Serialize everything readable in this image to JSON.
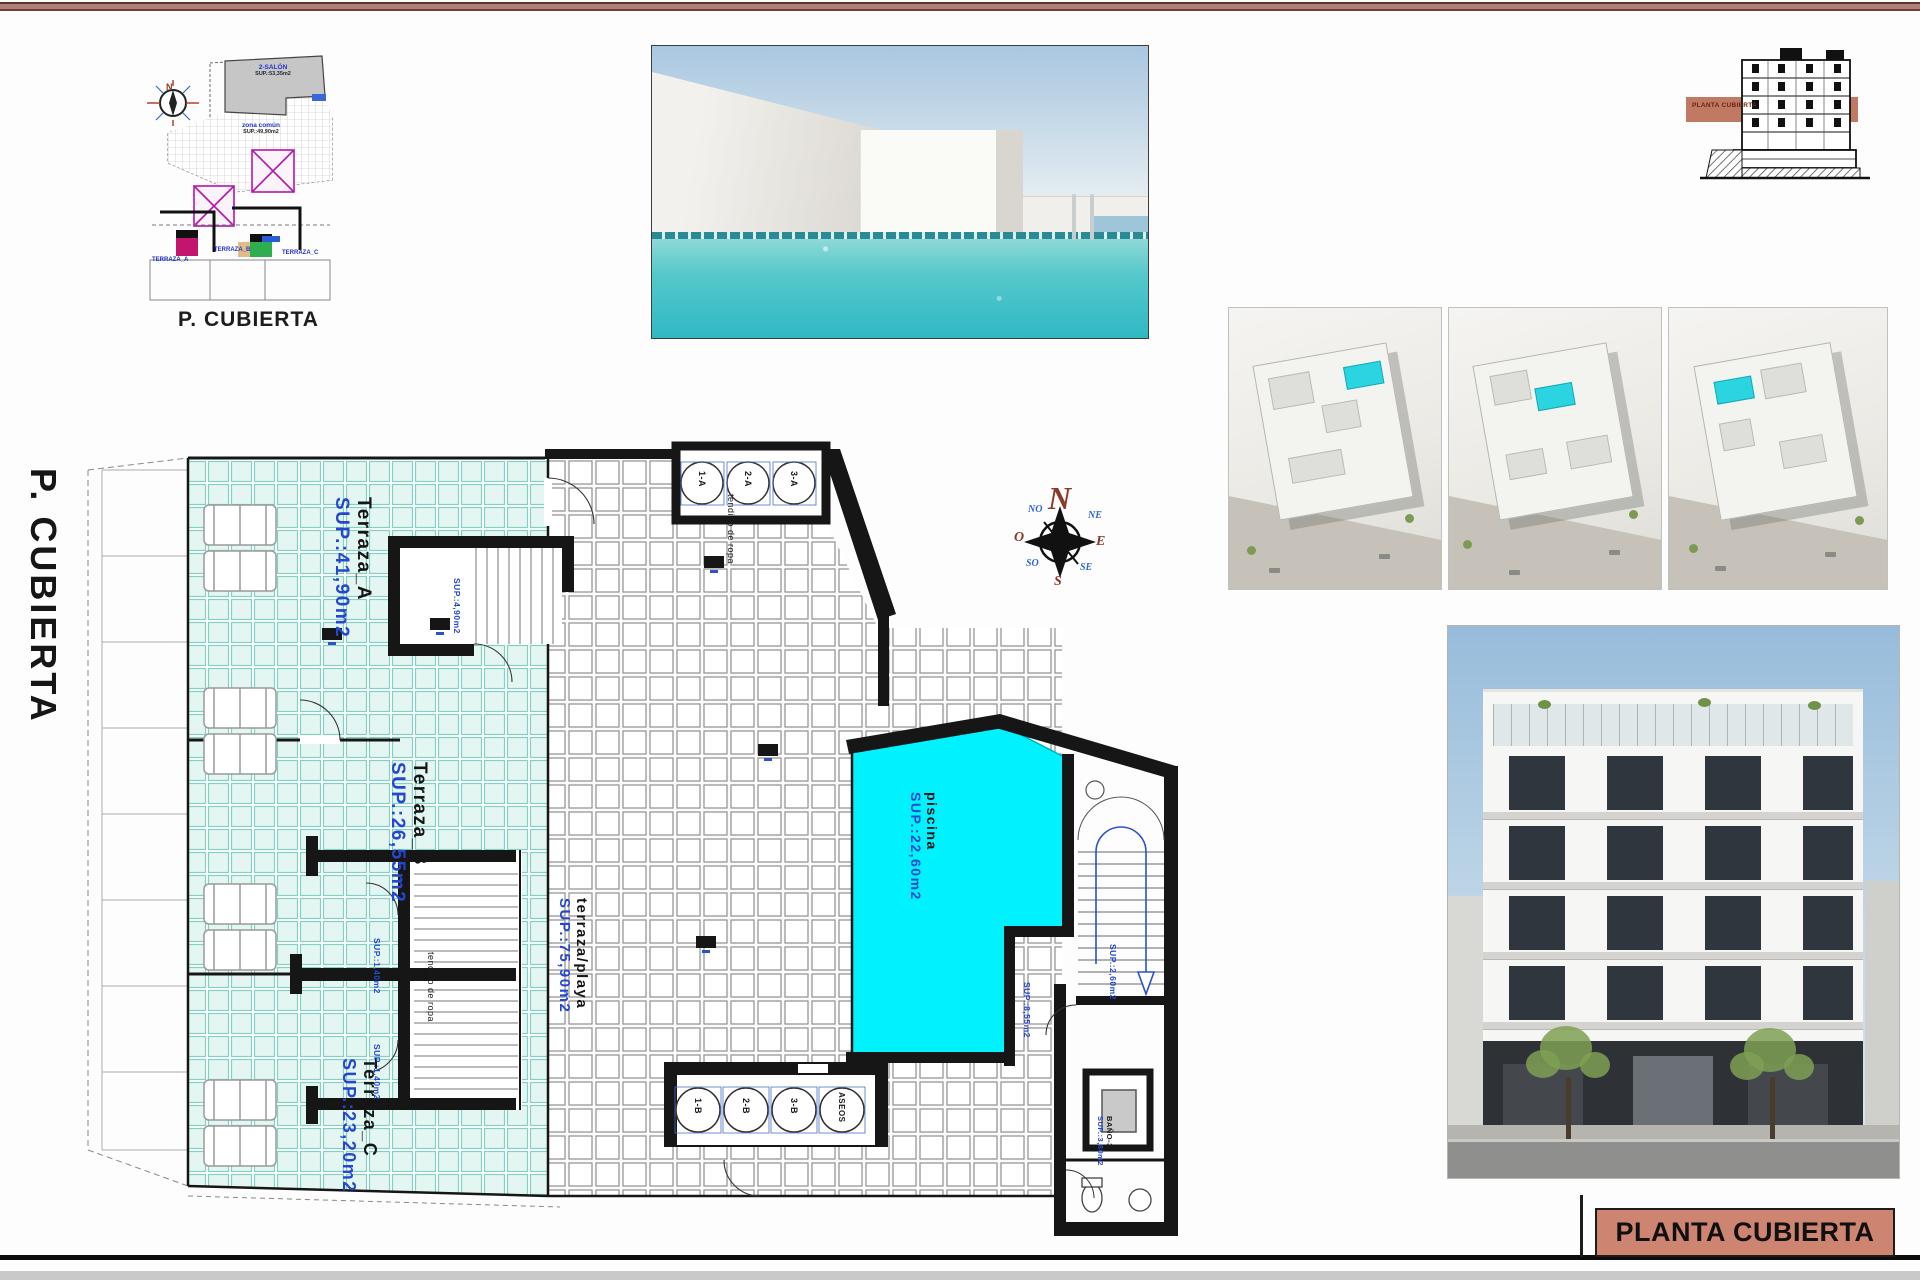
{
  "title_block": {
    "label": "PLANTA CUBIERTA"
  },
  "mini_plan": {
    "caption": "P. CUBIERTA",
    "compass_n": "N",
    "gray_area": {
      "name": "2-SALÓN",
      "sup": "SUP.:53,35m2"
    },
    "common_area": {
      "name": "zona común",
      "sup": "SUP.:49,90m2"
    },
    "unit_labels": [
      "TERRAZA_A",
      "TERRAZA_B",
      "TERRAZA_C"
    ]
  },
  "section_drawing": {
    "band_label": "PLANTA CUBIERTA"
  },
  "compass": {
    "n": "N",
    "s": "S",
    "e": "E",
    "o": "O",
    "ne": "NE",
    "no": "NO",
    "se": "SE",
    "so": "SO"
  },
  "plan": {
    "side_label": "P. CUBIERTA",
    "areas": {
      "terraza_a": {
        "name": "Terraza_A",
        "sup": "SUP.:41,90m2"
      },
      "terraza_b": {
        "name": "Terraza_B",
        "sup": "SUP.:26,55m2"
      },
      "terraza_c": {
        "name": "Terraza_C",
        "sup": "SUP.:23,20m2"
      },
      "playa": {
        "name": "terraza/playa",
        "sup": "SUP.:75,90m2"
      },
      "piscina": {
        "name": "piscina",
        "sup": "SUP.:22,60m2"
      }
    },
    "tendido_top": "tendido de ropa",
    "tendido_left": "tendido de ropa",
    "circles_top": [
      "1-A",
      "2-A",
      "3-A"
    ],
    "circles_bottom": [
      "1-B",
      "2-B",
      "3-B",
      "ASEOS"
    ],
    "small_sups": {
      "stair_a": "SUP.:4,90m2",
      "stair_b1": "SUP.:1,40m2",
      "stair_b2": "SUP.:1,40m2",
      "stair_right": "SUP.:2,60m2",
      "room_right": "SUP.:8,55m2",
      "bano_name": "BAÑO-3",
      "bano_sup": "SUP.:3,80m2"
    }
  },
  "colors": {
    "pool": "#00f2ff",
    "accent_band": "#c07a63",
    "title_bg": "#cd8470"
  }
}
